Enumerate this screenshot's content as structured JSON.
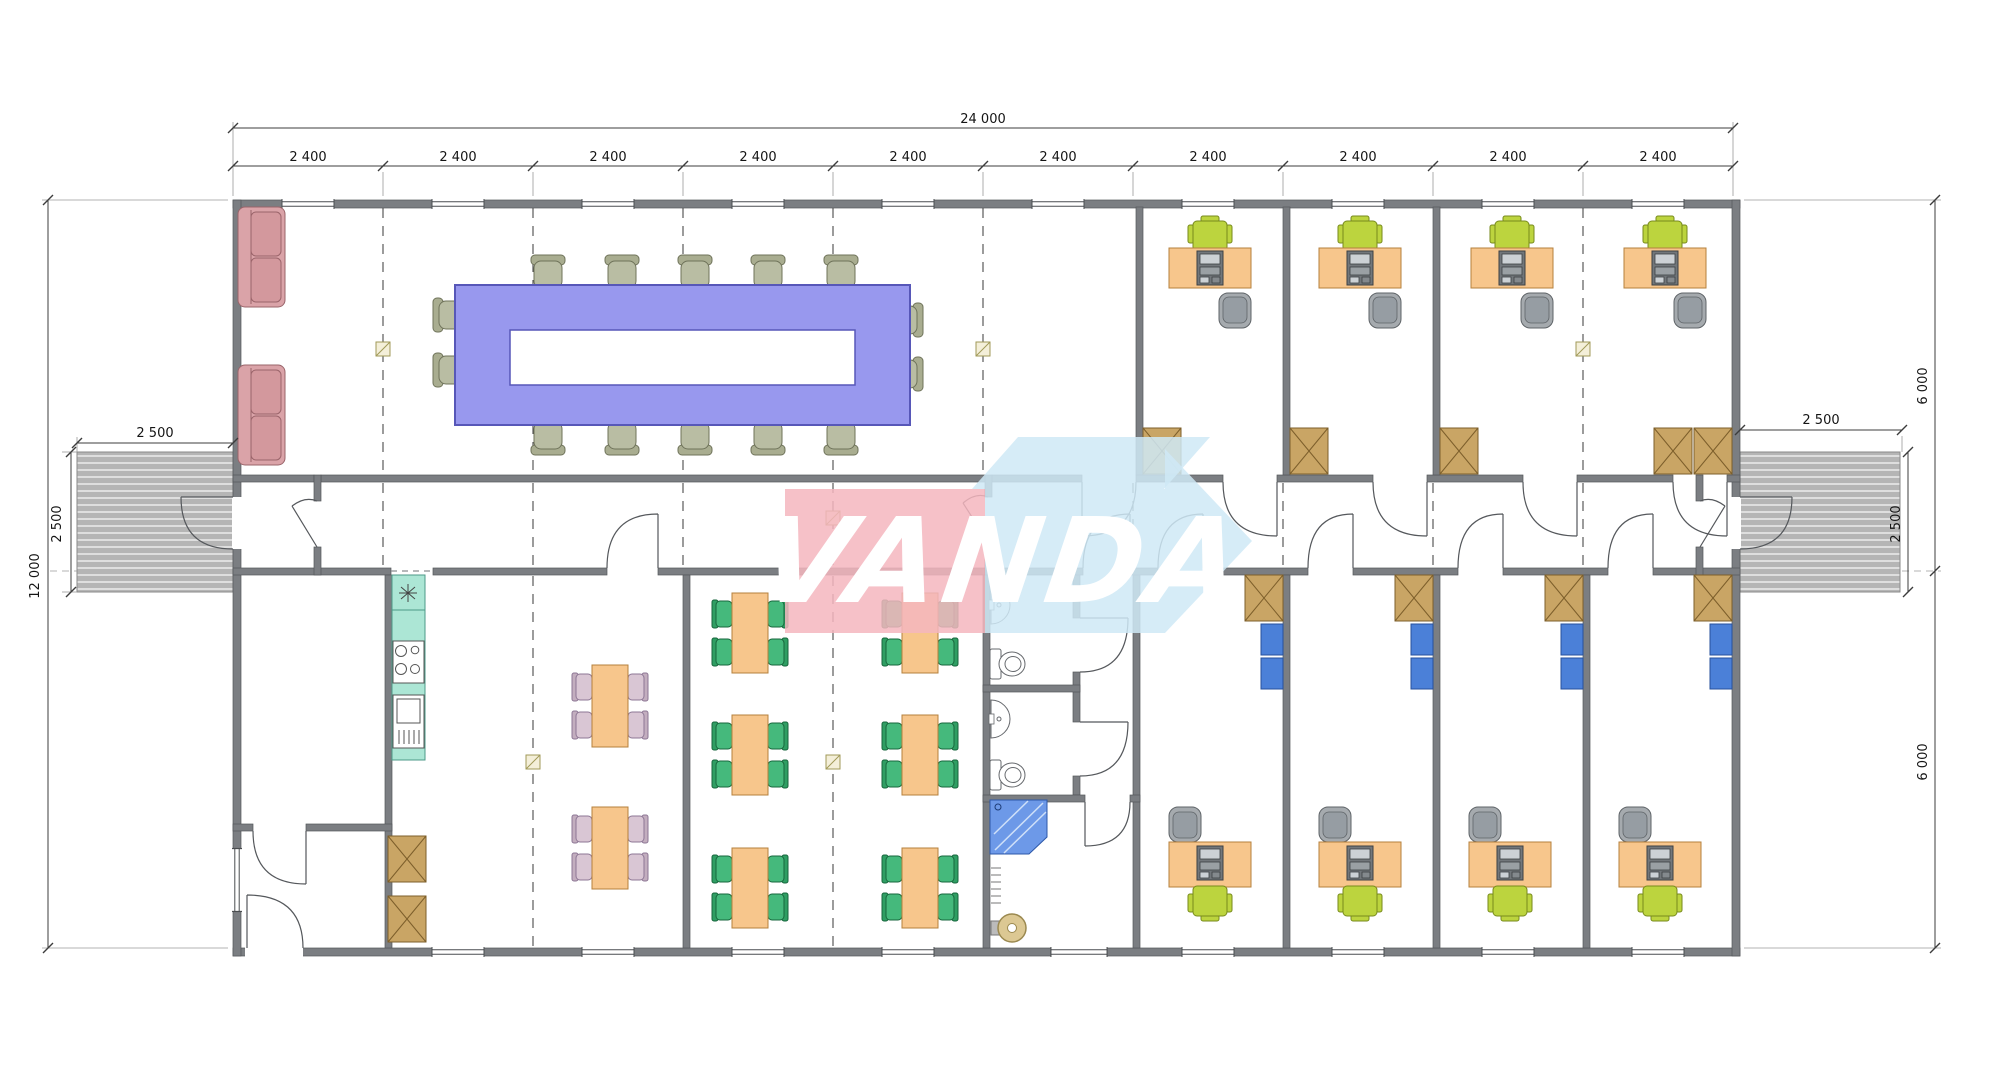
{
  "watermark": {
    "text": "VANDA",
    "pink": "#f5b6be",
    "blue": "#cfe9f6"
  },
  "dims": {
    "total_width": "24 000",
    "bays": [
      "2 400",
      "2 400",
      "2 400",
      "2 400",
      "2 400",
      "2 400",
      "2 400",
      "2 400",
      "2 400",
      "2 400"
    ],
    "total_height": "12 000",
    "right_upper_height": "6 000",
    "right_lower_height": "6 000",
    "left_ramp_width": "2 500",
    "left_ramp_depth": "2 500",
    "right_ramp_width": "2 500",
    "right_ramp_depth": "2 500"
  },
  "colors": {
    "wall": "#7b7e82",
    "conference_table": "#9898ee",
    "desk": "#f7c68c",
    "task_chair": "#bcd43e",
    "canteen_chair": "#45b97c",
    "dining_chair": "#d9c6d4",
    "sofa": "#daa3a8",
    "kitchen_counter": "#ace6d5",
    "cabinet": "#c9a565",
    "shelf": "#4b80d8",
    "shower": "#6d99e8",
    "ramp": "#b5b5b5"
  }
}
